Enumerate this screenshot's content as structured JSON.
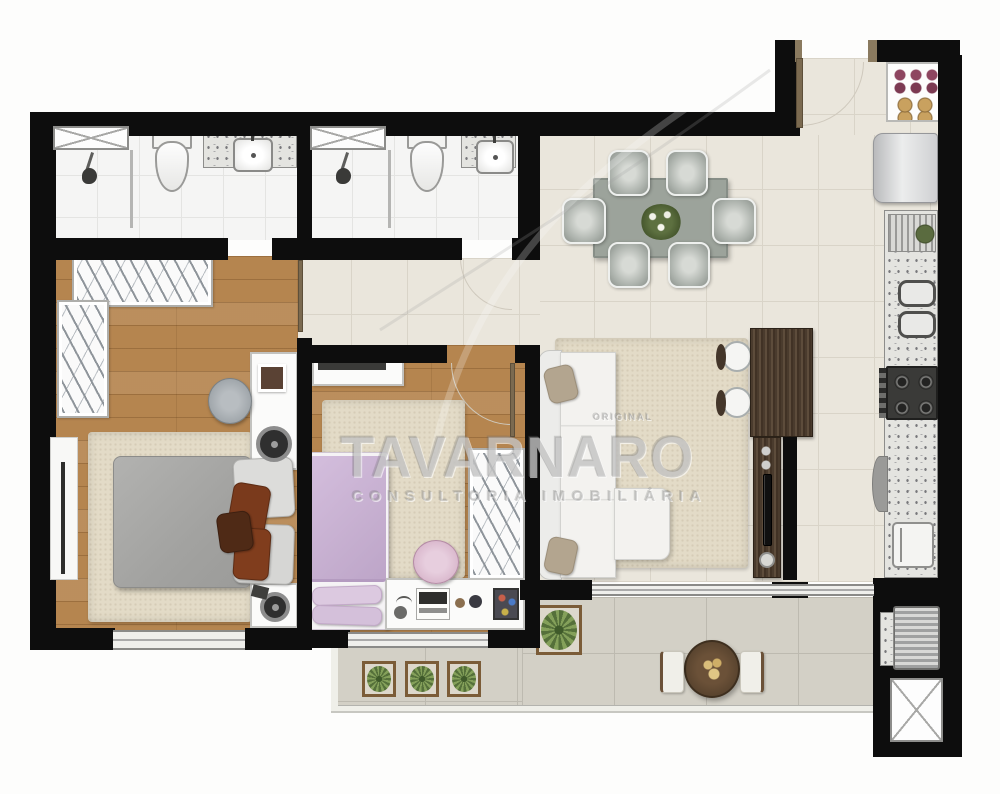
{
  "watermark": {
    "brand": "TAVARNARO",
    "tagline": "CONSULTORIA IMOBILIÁRIA",
    "corner_label": "ORIGINAL"
  },
  "palette": {
    "wall": "#0d0d0d",
    "wood_floor": "#b5854f",
    "tile_floor": "#eae6dc",
    "tile_grout": "#d9d4c8",
    "bath_tile": "#f5f5f4",
    "bath_grout": "#e4e4e2",
    "balcony_tile": "#d3d0c6",
    "balcony_grout": "#bdbab0",
    "rug": "#e3dbc7",
    "dark_wood": "#4c3e30",
    "granite": "#e4e4e0",
    "sofa_white": "#f3f2ef",
    "bed_gray": "#a9a9a9",
    "bed_lilac": "#cab3d3",
    "accent_pillow": "#7a3a1c",
    "dining_table": "#9ca39b",
    "watermark_gray": "#969696"
  }
}
